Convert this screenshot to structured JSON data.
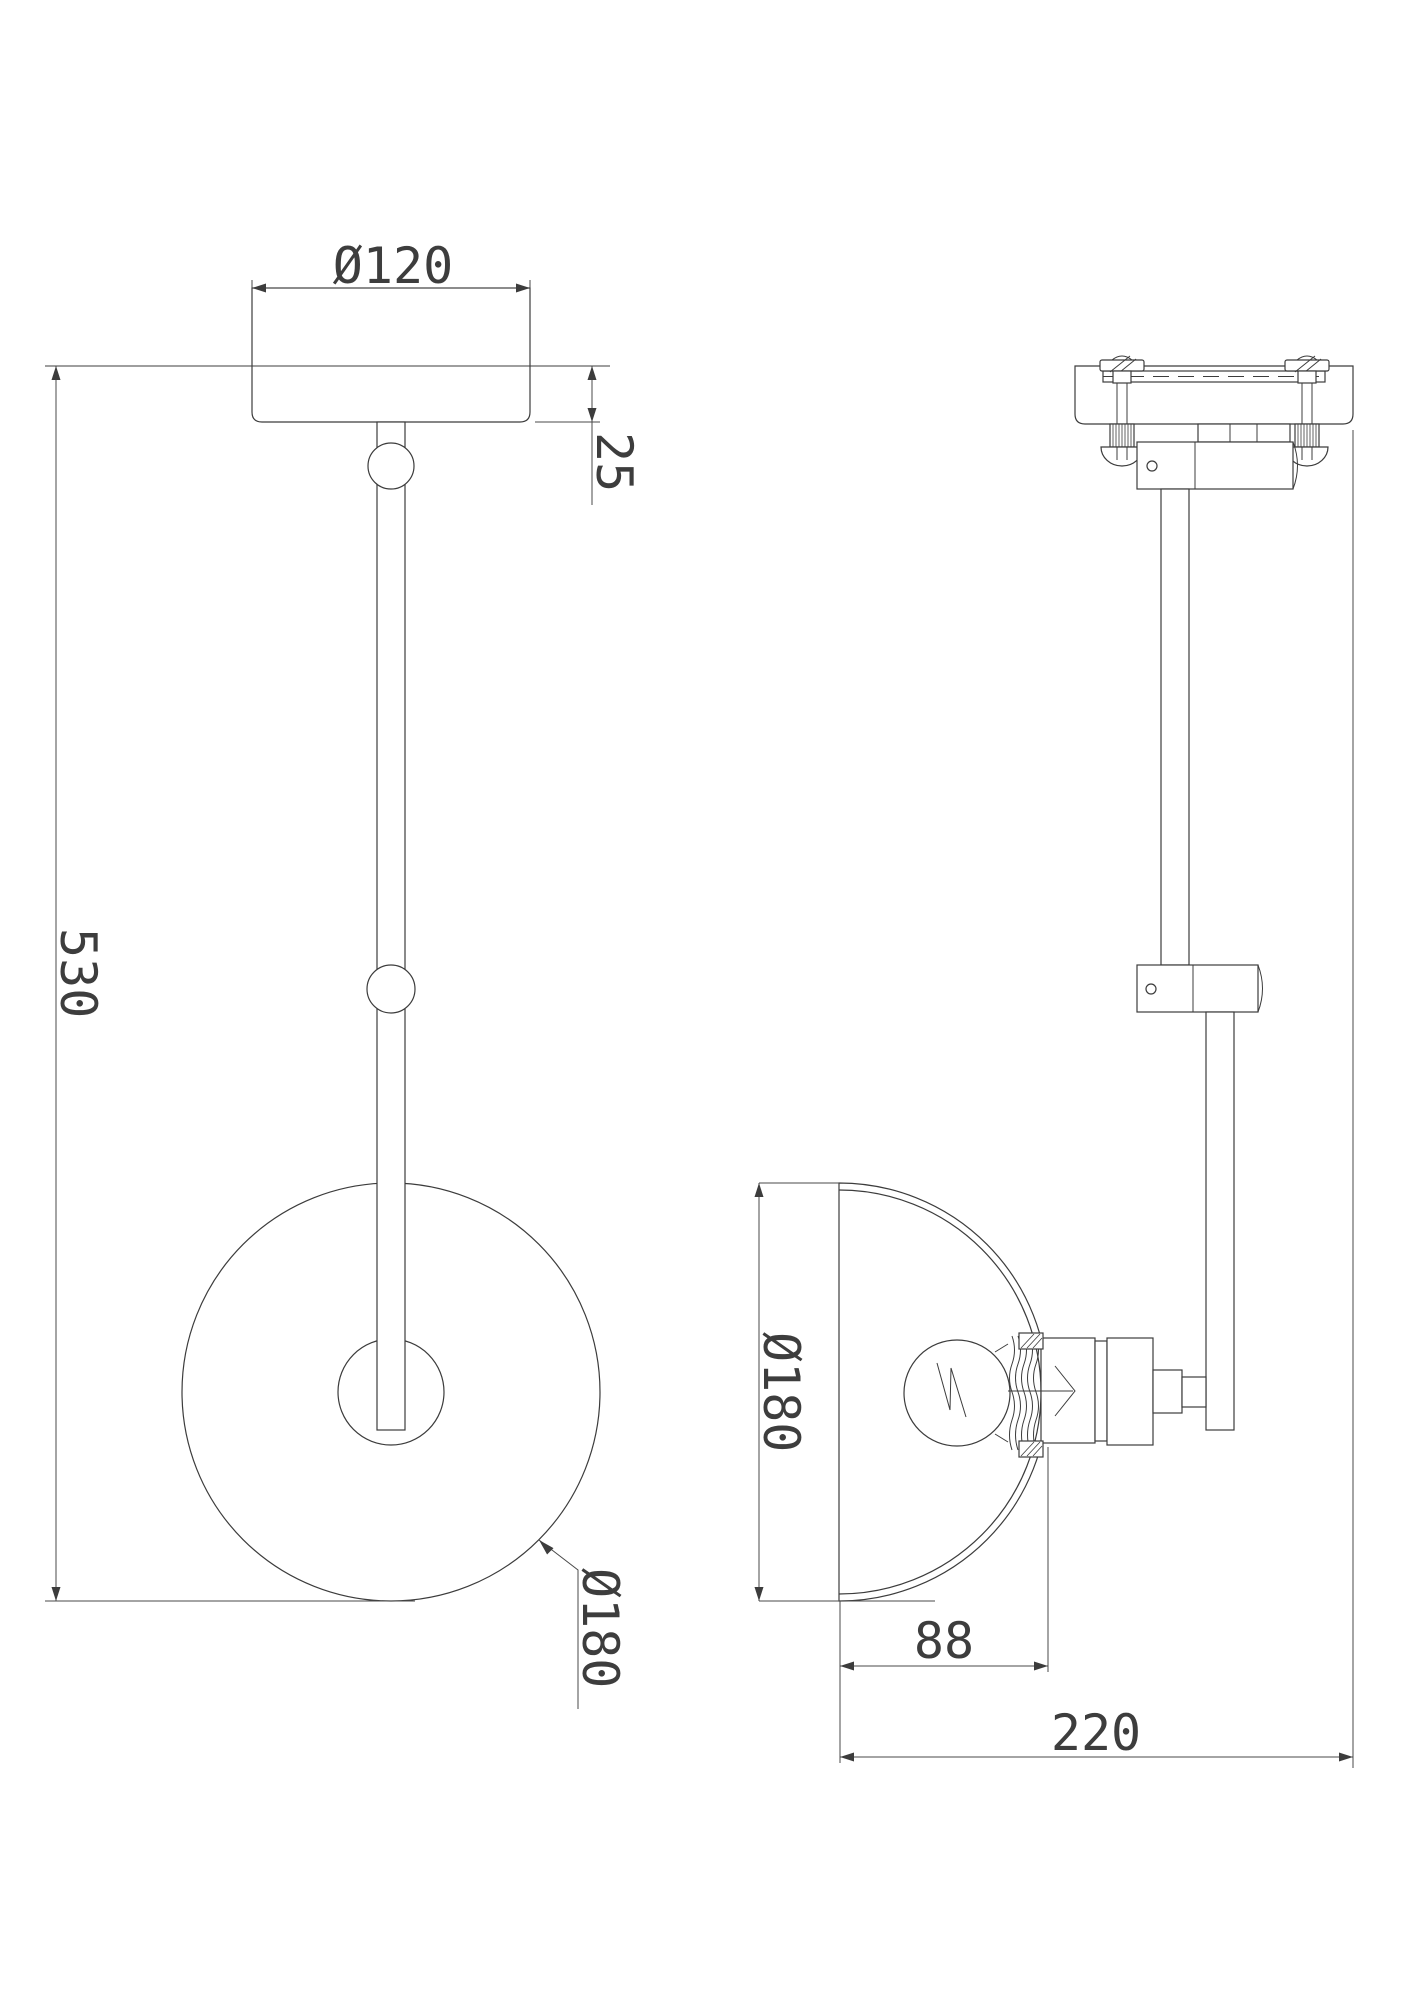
{
  "drawing": {
    "background_color": "#ffffff",
    "line_color": "#3c3c3c",
    "dimensions": {
      "canopy_diameter": "Ø120",
      "canopy_depth": "25",
      "overall_height": "530",
      "shade_diameter_front": "Ø180",
      "shade_diameter_side": "Ø180",
      "shade_depth": "88",
      "overall_projection": "220"
    }
  }
}
